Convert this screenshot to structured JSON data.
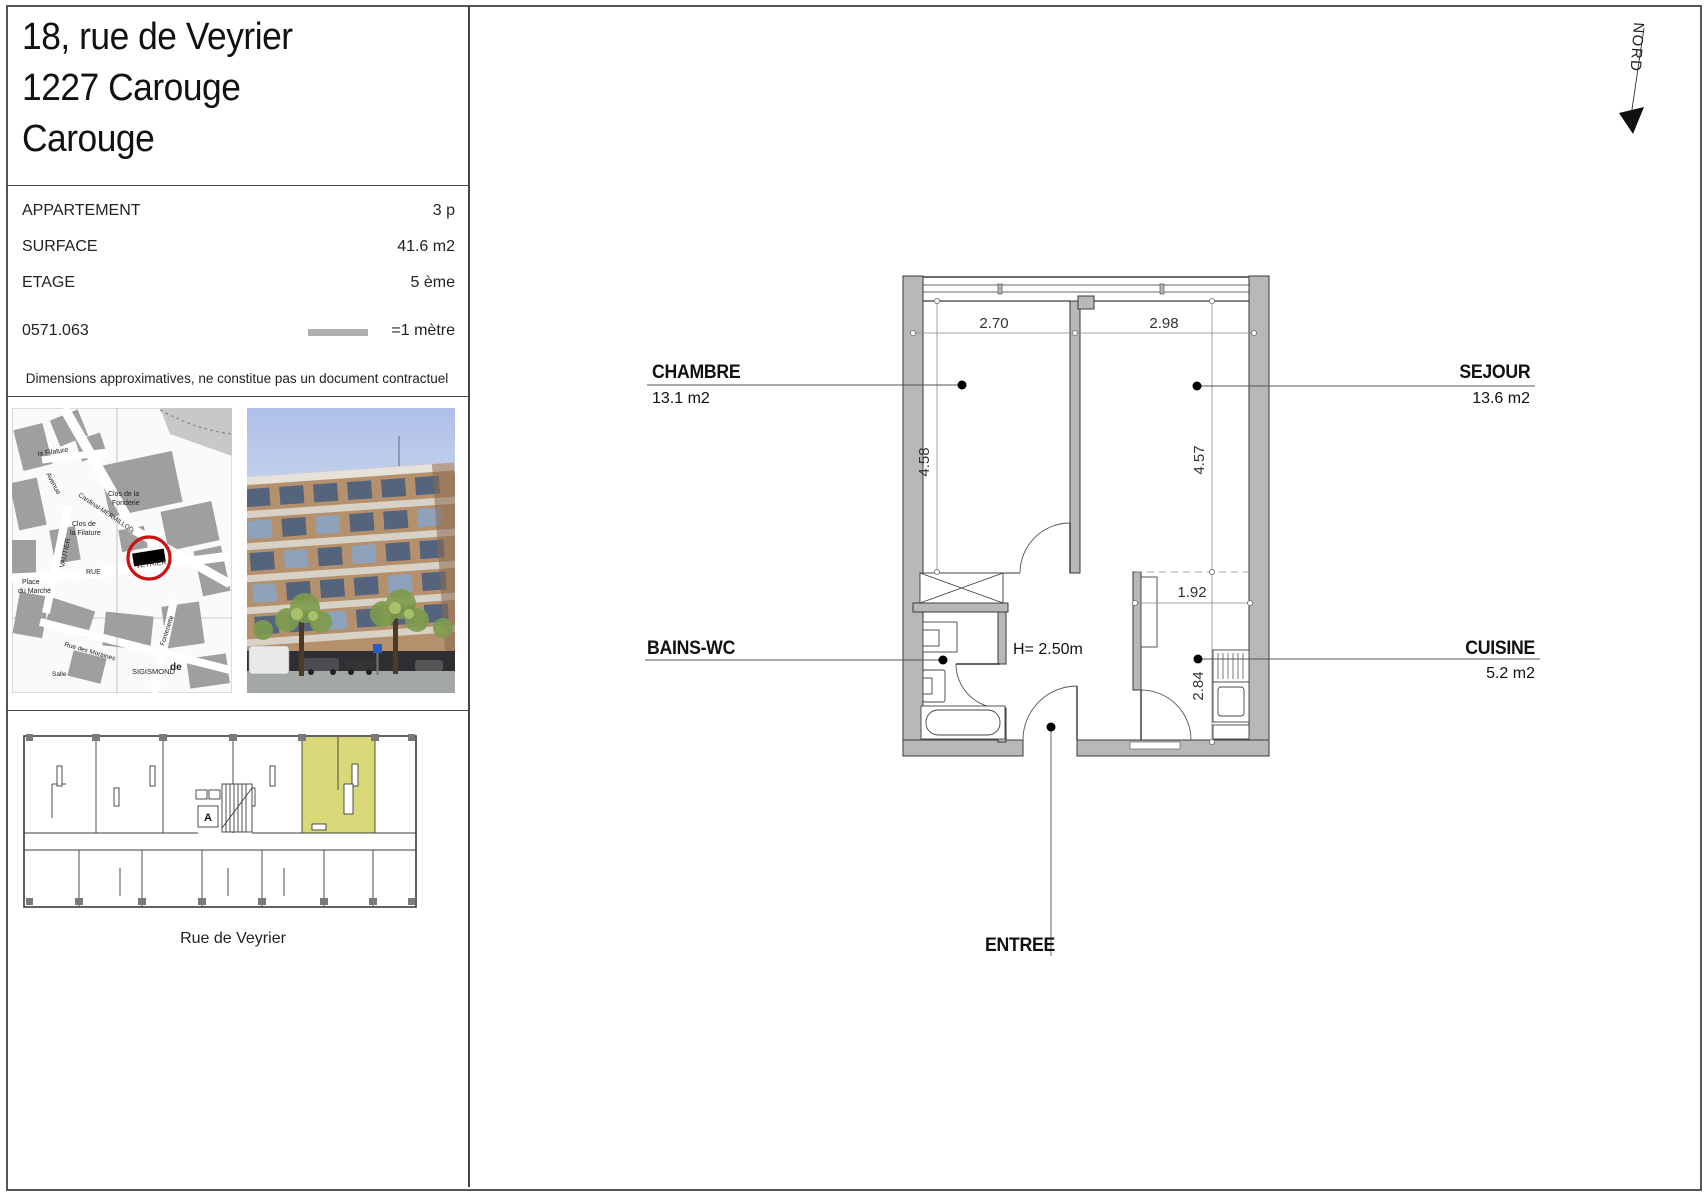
{
  "header": {
    "address_lines": [
      "18, rue de Veyrier",
      "1227 Carouge",
      "Carouge"
    ]
  },
  "info": {
    "rows": [
      {
        "label": "APPARTEMENT",
        "value": "3 p"
      },
      {
        "label": "SURFACE",
        "value": "41.6 m2"
      },
      {
        "label": "ETAGE",
        "value": "5 ème"
      }
    ],
    "reference": "0571.063",
    "scale_label": "=1 mètre",
    "disclaimer": "Dimensions approximatives, ne constitue pas un document contractuel"
  },
  "map": {
    "labels": [
      "Avenue",
      "Cardinal-MERMILLOD",
      "la Filature",
      "Clos de la",
      "Fonderie",
      "Clos de",
      "la Filature",
      "VAUTIER",
      "RUE",
      "VEYRIER",
      "Place",
      "du Marché",
      "Rue des Moraines",
      "Fontenette",
      "SIGISMOND",
      "de",
      "Salle"
    ]
  },
  "overview": {
    "street_label": "Rue de Veyrier",
    "elevator_label": "A",
    "highlight_color": "#d9d97a"
  },
  "plan": {
    "north_label": "NORD",
    "rooms": {
      "chambre": {
        "name": "CHAMBRE",
        "area": "13.1 m2"
      },
      "sejour": {
        "name": "SEJOUR",
        "area": "13.6 m2"
      },
      "bains": {
        "name": "BAINS-WC"
      },
      "cuisine": {
        "name": "CUISINE",
        "area": "5.2 m2"
      },
      "entree": {
        "name": "ENTREE"
      }
    },
    "ceiling_height": "H= 2.50m",
    "dimensions": {
      "chambre_w": "2.70",
      "sejour_w": "2.98",
      "chambre_d": "4.58",
      "sejour_d": "4.57",
      "cuisine_w": "1.92",
      "cuisine_d": "2.84"
    }
  },
  "colors": {
    "wall_fill": "#b8b8b8",
    "highlight": "#d9d97a",
    "map_circle": "#cc1111"
  }
}
